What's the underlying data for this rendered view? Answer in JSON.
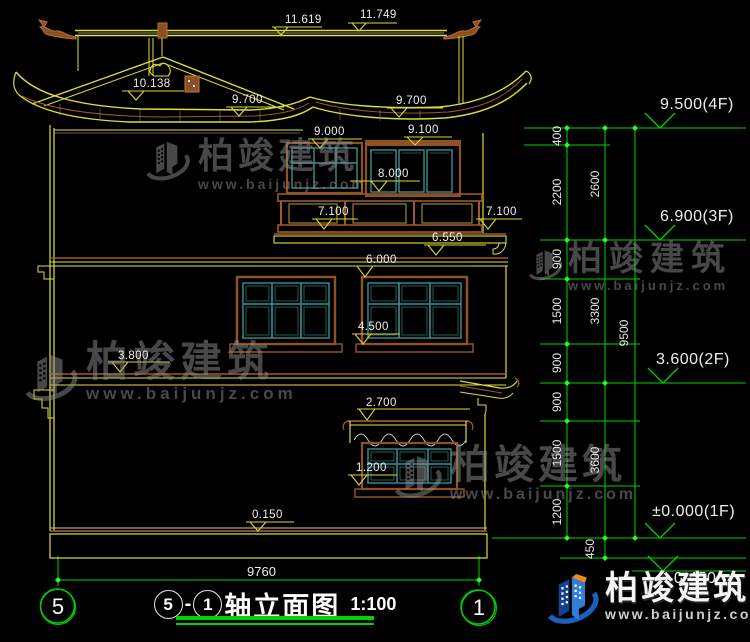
{
  "title": {
    "axis_a": "5",
    "dash": "-",
    "axis_b": "1",
    "name": "轴立面图",
    "scale": "1:100"
  },
  "axes": {
    "left": "5",
    "right": "1"
  },
  "flags_left": [
    "11.619",
    "11.749",
    "10.138",
    "9.700",
    "9.700",
    "9.000",
    "9.100",
    "8.000",
    "7.100",
    "7.100",
    "6.550",
    "6.000",
    "4.500",
    "3.800",
    "2.700",
    "1.200",
    "0.150"
  ],
  "flags_right": [
    "9.500(4F)",
    "6.900(3F)",
    "3.600(2F)",
    "±0.000(1F)",
    "-0.450"
  ],
  "dims": {
    "col1": [
      "400",
      "2200",
      "900",
      "1500",
      "900",
      "900",
      "1500",
      "1200"
    ],
    "col2": [
      "2600",
      "3300",
      "3600",
      "450"
    ],
    "col3": [
      "9500"
    ],
    "total_width": "9760"
  },
  "brand": {
    "name": "柏竣建筑",
    "site": "www.baijunjz.com"
  },
  "colors": {
    "line_yellow": "#dede3a",
    "line_brown": "#9c5a28",
    "line_teal": "#3a9090",
    "dim_green": "#00d400",
    "logo_blue": "#2f7fd6",
    "background": "#000000"
  }
}
